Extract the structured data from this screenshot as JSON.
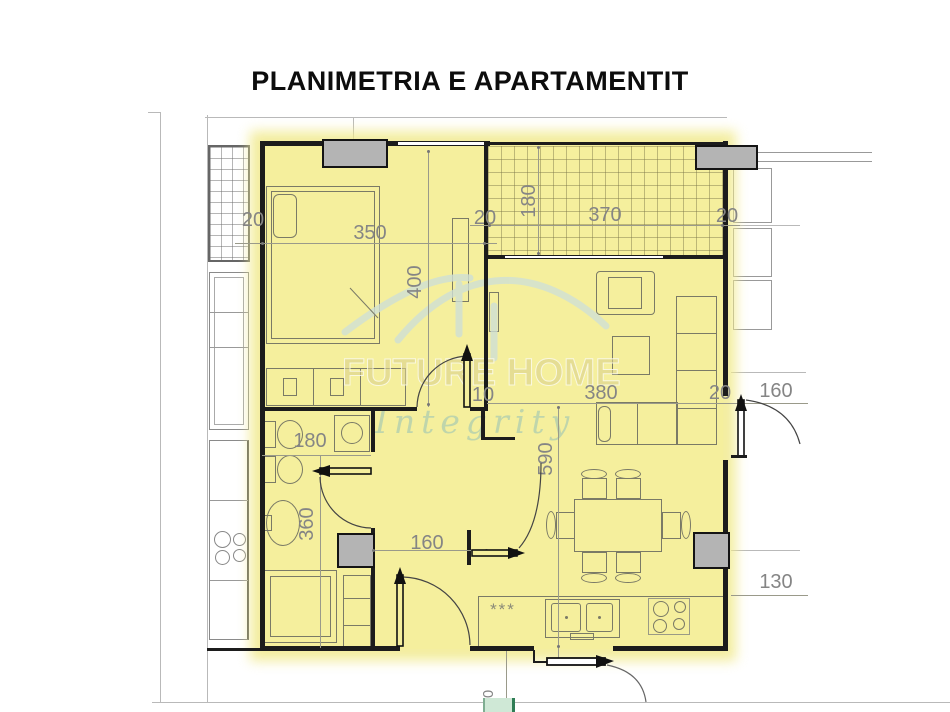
{
  "title": "PLANIMETRIA E APARTAMENTIT",
  "watermark": {
    "brand": "FUTURE HOME",
    "tagline": "Integrity"
  },
  "kitchen": {
    "marks": "***"
  },
  "dims": [
    {
      "name": "bedroom-left-wall",
      "value": "20",
      "orientation": "horizontal"
    },
    {
      "name": "bedroom-width",
      "value": "350",
      "orientation": "horizontal"
    },
    {
      "name": "bedroom-right-wall",
      "value": "20",
      "orientation": "horizontal"
    },
    {
      "name": "balcony-depth",
      "value": "180",
      "orientation": "vertical"
    },
    {
      "name": "balcony-width",
      "value": "370",
      "orientation": "horizontal"
    },
    {
      "name": "balcony-right-wall",
      "value": "20",
      "orientation": "horizontal"
    },
    {
      "name": "bedroom-height",
      "value": "400",
      "orientation": "vertical"
    },
    {
      "name": "partition-stub",
      "value": "10",
      "orientation": "horizontal"
    },
    {
      "name": "living-width",
      "value": "380",
      "orientation": "horizontal"
    },
    {
      "name": "living-right-wall",
      "value": "20",
      "orientation": "horizontal"
    },
    {
      "name": "right-door-width",
      "value": "160",
      "orientation": "horizontal"
    },
    {
      "name": "living-height",
      "value": "590",
      "orientation": "vertical"
    },
    {
      "name": "bathroom-width",
      "value": "180",
      "orientation": "horizontal"
    },
    {
      "name": "bathroom-height",
      "value": "360",
      "orientation": "vertical"
    },
    {
      "name": "hall-width",
      "value": "160",
      "orientation": "horizontal"
    },
    {
      "name": "right-offset",
      "value": "130",
      "orientation": "horizontal"
    },
    {
      "name": "bottom-offset",
      "value": "0",
      "orientation": "vertical"
    }
  ],
  "colors": {
    "apartment_fill": "#f5ef9d",
    "wall": "#1c1c1c",
    "column_fill": "#b4b4b4",
    "dimension_text": "#858585",
    "watermark_brand": "rgba(219,209,140,0.60)",
    "watermark_tagline": "rgba(168,202,176,0.70)",
    "watermark_roof": "#cfe0d6",
    "entry_marker_green": "#cfe8d6"
  }
}
